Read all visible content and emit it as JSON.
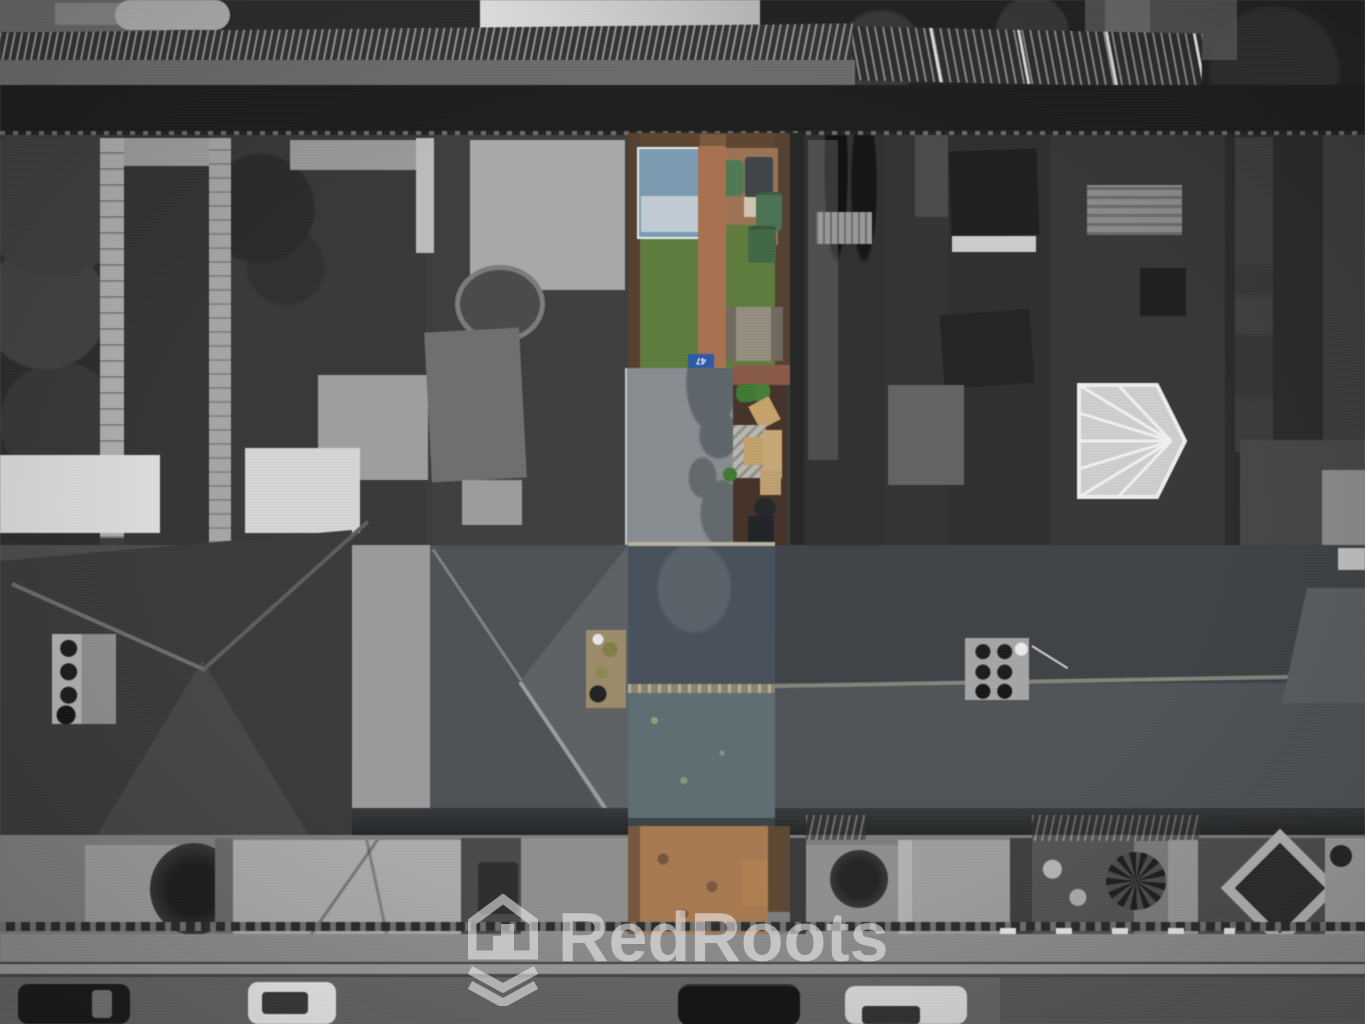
{
  "watermark": {
    "brand": "RedRoots",
    "icon": "house-with-roots-icon",
    "color": "#f5f5f5",
    "opacity": 0.55
  },
  "scene": {
    "kind": "aerial-drone-photograph",
    "treatment": "grayscale surroundings with a single terraced property highlighted in colour",
    "setting": "rows of terraced houses: rear alley and back gardens at top, main rooftops across the middle, front yards, pavement and street with parked cars at bottom",
    "highlighted_property": {
      "house_number": "47",
      "features": [
        "rear garden with green artificial lawn",
        "brick garden path",
        "blue-roofed garden shed",
        "green wheelie bins and water butt",
        "wooden picnic bench",
        "timber decking with garden furniture and chevron rug",
        "grey flat-roof rear extension",
        "slate pitched main roof with mossy ridge",
        "brick chimney stack",
        "brick front yard with timber gate"
      ]
    },
    "colors": {
      "lawn_green": "#5f7d3e",
      "garden_path_brick": "#a9714f",
      "patio_brick": "#9c7354",
      "front_yard_brick": "#a87a52",
      "shed_roof_blue": "#7b9cb2",
      "shed_panel_light": "#c2cdd5",
      "wheelie_bin_green": "#4a7252",
      "decking_brown": "#45332a",
      "roof_slate_dark": "#47515b",
      "roof_slate_light": "#5d6f74",
      "ridge_moss": "#8c856a",
      "fence_brown": "#5d4531",
      "gate_timber": "#b08050",
      "chimney_brick_moss": "#9d8c6b",
      "number_board_blue": "#2d59a9"
    }
  }
}
